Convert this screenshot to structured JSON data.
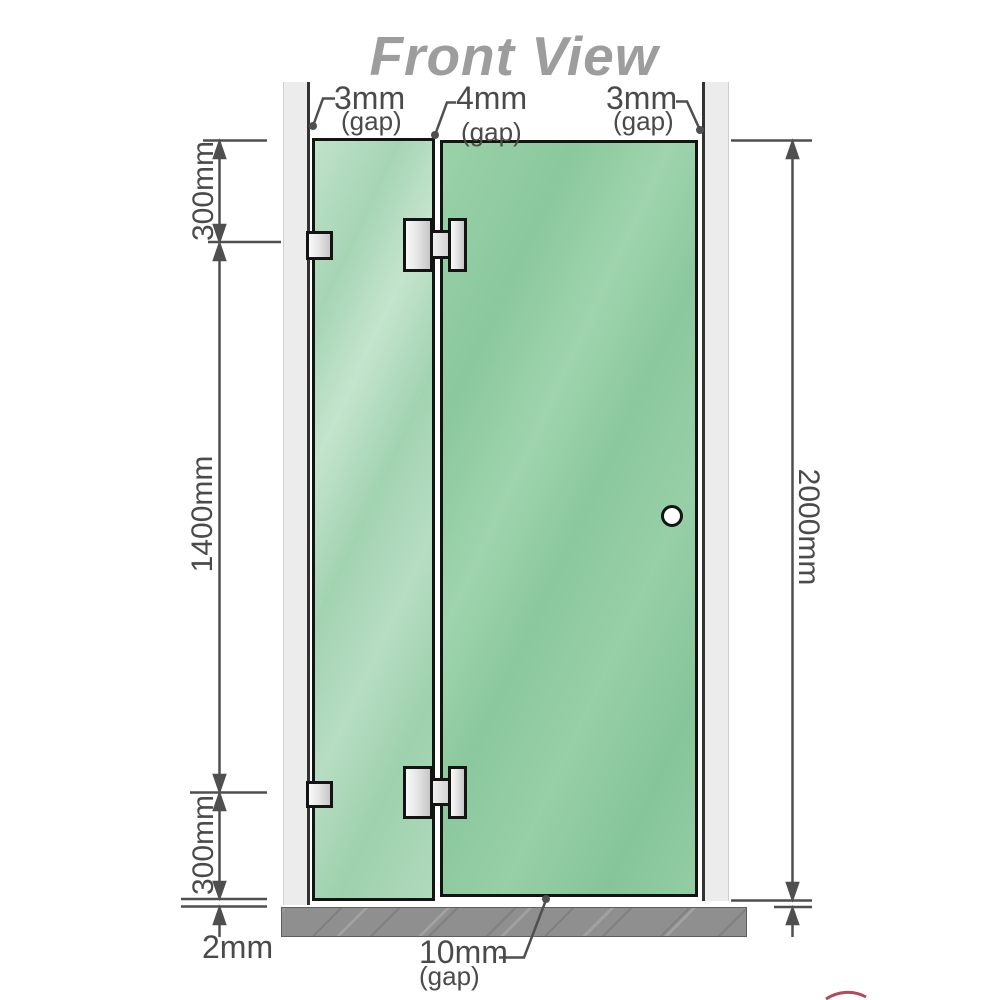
{
  "title": "Front View",
  "gaps": {
    "top_left": {
      "value": "3mm",
      "label": "(gap)"
    },
    "top_middle": {
      "value": "4mm",
      "label": "(gap)"
    },
    "top_right": {
      "value": "3mm",
      "label": "(gap)"
    },
    "bottom_door": {
      "value": "10mm",
      "label": "(gap)"
    },
    "bottom_floor": {
      "value": "2mm"
    }
  },
  "dimensions": {
    "left_top": "300mm",
    "left_middle": "1400mm",
    "left_bottom": "300mm",
    "right_full": "2000mm"
  },
  "colors": {
    "glass_fixed": "#a8d6b5",
    "glass_door": "#8fcba2",
    "wall_channel": "#ececec",
    "floor": "#8f8f8f",
    "dimension_line": "#4f4f4f",
    "title_text": "#9d9d9d",
    "hardware_outline": "#141414",
    "watermark_red": "#a52a3a"
  }
}
